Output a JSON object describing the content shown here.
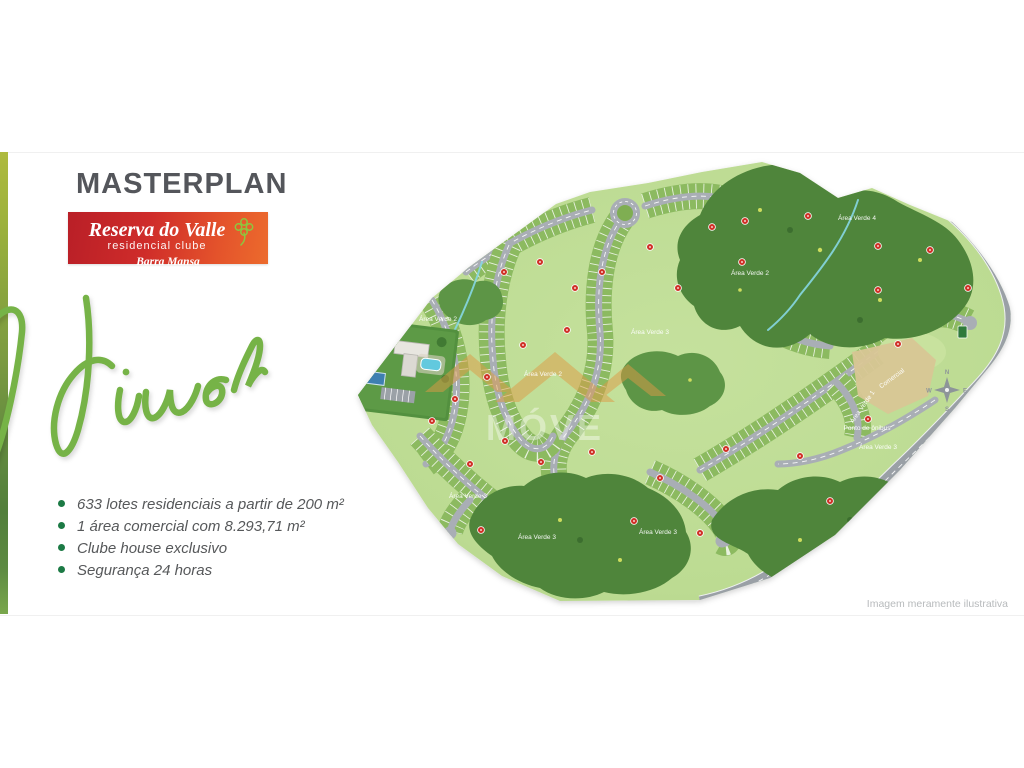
{
  "header": {
    "title": "MASTERPLAN"
  },
  "logo": {
    "name": "Reserva do Valle",
    "subtitle": "residencial clube",
    "city": "Barra Mansa",
    "icon": "clover-icon",
    "gradient_from": "#b91f27",
    "gradient_to": "#ec6b2d"
  },
  "script_word": {
    "text": "Viver",
    "color": "#76b347"
  },
  "features": {
    "bullet_color": "#1c7a45",
    "items": [
      "633 lotes residenciais a partir de 200 m²",
      "1 área comercial com 8.293,71 m²",
      "Clube house exclusivo",
      "Segurança 24 horas"
    ]
  },
  "map": {
    "disclaimer": "Imagem meramente ilustrativa",
    "watermark_text": "MÓVE",
    "compass": {
      "cx": 947,
      "cy": 390,
      "n": "N",
      "e": "E",
      "s": "S",
      "w": "W"
    },
    "labels": [
      {
        "text": "Área Verde 2",
        "x": 438,
        "y": 321
      },
      {
        "text": "Área Verde 2",
        "x": 543,
        "y": 376
      },
      {
        "text": "Área Verde 3",
        "x": 650,
        "y": 334
      },
      {
        "text": "Área Verde 2",
        "x": 750,
        "y": 275
      },
      {
        "text": "Área Verde 4",
        "x": 857,
        "y": 220
      },
      {
        "text": "Área Verde 3",
        "x": 468,
        "y": 498
      },
      {
        "text": "Área Verde 3",
        "x": 537,
        "y": 539
      },
      {
        "text": "Área Verde 3",
        "x": 658,
        "y": 534
      },
      {
        "text": "Área Verde 3",
        "x": 878,
        "y": 449
      },
      {
        "text": "Ponto de ônibus",
        "x": 867,
        "y": 430
      },
      {
        "text": "Área Verde 1",
        "x": 864,
        "y": 408,
        "rotate": -55
      },
      {
        "text": "Comercial",
        "x": 893,
        "y": 380,
        "rotate": -36
      }
    ],
    "markers": [
      {
        "x": 504,
        "y": 272
      },
      {
        "x": 540,
        "y": 262
      },
      {
        "x": 575,
        "y": 288
      },
      {
        "x": 602,
        "y": 272
      },
      {
        "x": 650,
        "y": 247
      },
      {
        "x": 678,
        "y": 288
      },
      {
        "x": 712,
        "y": 227
      },
      {
        "x": 745,
        "y": 221
      },
      {
        "x": 808,
        "y": 216
      },
      {
        "x": 878,
        "y": 246
      },
      {
        "x": 930,
        "y": 250
      },
      {
        "x": 968,
        "y": 288
      },
      {
        "x": 878,
        "y": 290
      },
      {
        "x": 742,
        "y": 262
      },
      {
        "x": 567,
        "y": 330
      },
      {
        "x": 523,
        "y": 345
      },
      {
        "x": 487,
        "y": 377
      },
      {
        "x": 455,
        "y": 399
      },
      {
        "x": 432,
        "y": 421
      },
      {
        "x": 505,
        "y": 441
      },
      {
        "x": 470,
        "y": 464
      },
      {
        "x": 541,
        "y": 462
      },
      {
        "x": 592,
        "y": 452
      },
      {
        "x": 660,
        "y": 478
      },
      {
        "x": 726,
        "y": 449
      },
      {
        "x": 800,
        "y": 456
      },
      {
        "x": 830,
        "y": 501
      },
      {
        "x": 868,
        "y": 419
      },
      {
        "x": 634,
        "y": 521
      },
      {
        "x": 700,
        "y": 533
      },
      {
        "x": 481,
        "y": 530
      },
      {
        "x": 898,
        "y": 344
      }
    ],
    "colors": {
      "terrain": "#bcdb92",
      "lots": "#8cba60",
      "road": "#a9aeb5",
      "external_road": "#9aa0a6",
      "forest": "#4f853b",
      "water": "#86d7e3",
      "marker": "#d03026",
      "commercial_area": "#d8c695",
      "watermark": "#de9a45"
    }
  }
}
